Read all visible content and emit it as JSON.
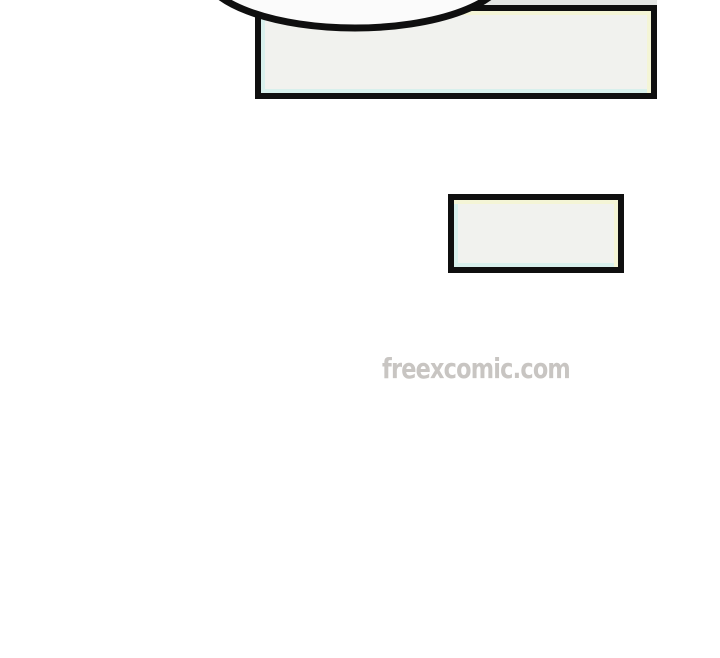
{
  "page": {
    "type": "comic-page"
  },
  "watermark": {
    "text": "freexcomic.com"
  },
  "speech_bubble": {
    "text": ""
  },
  "dialogue_boxes": [
    {
      "id": "large-top",
      "text": ""
    },
    {
      "id": "small-middle",
      "text": ""
    }
  ],
  "colors": {
    "page-bg": "#ffffff",
    "ink": "#0f0f0f",
    "box-fill": "#f1f2ee",
    "tint-yellow": "#f4f5d6",
    "tint-cyan": "#d8f0ec",
    "gap-strip": "#e4e6e4",
    "bubble-fill": "#fbfbfb",
    "watermark": "#c8c5c2",
    "watermark-outline": "#ffffff"
  }
}
